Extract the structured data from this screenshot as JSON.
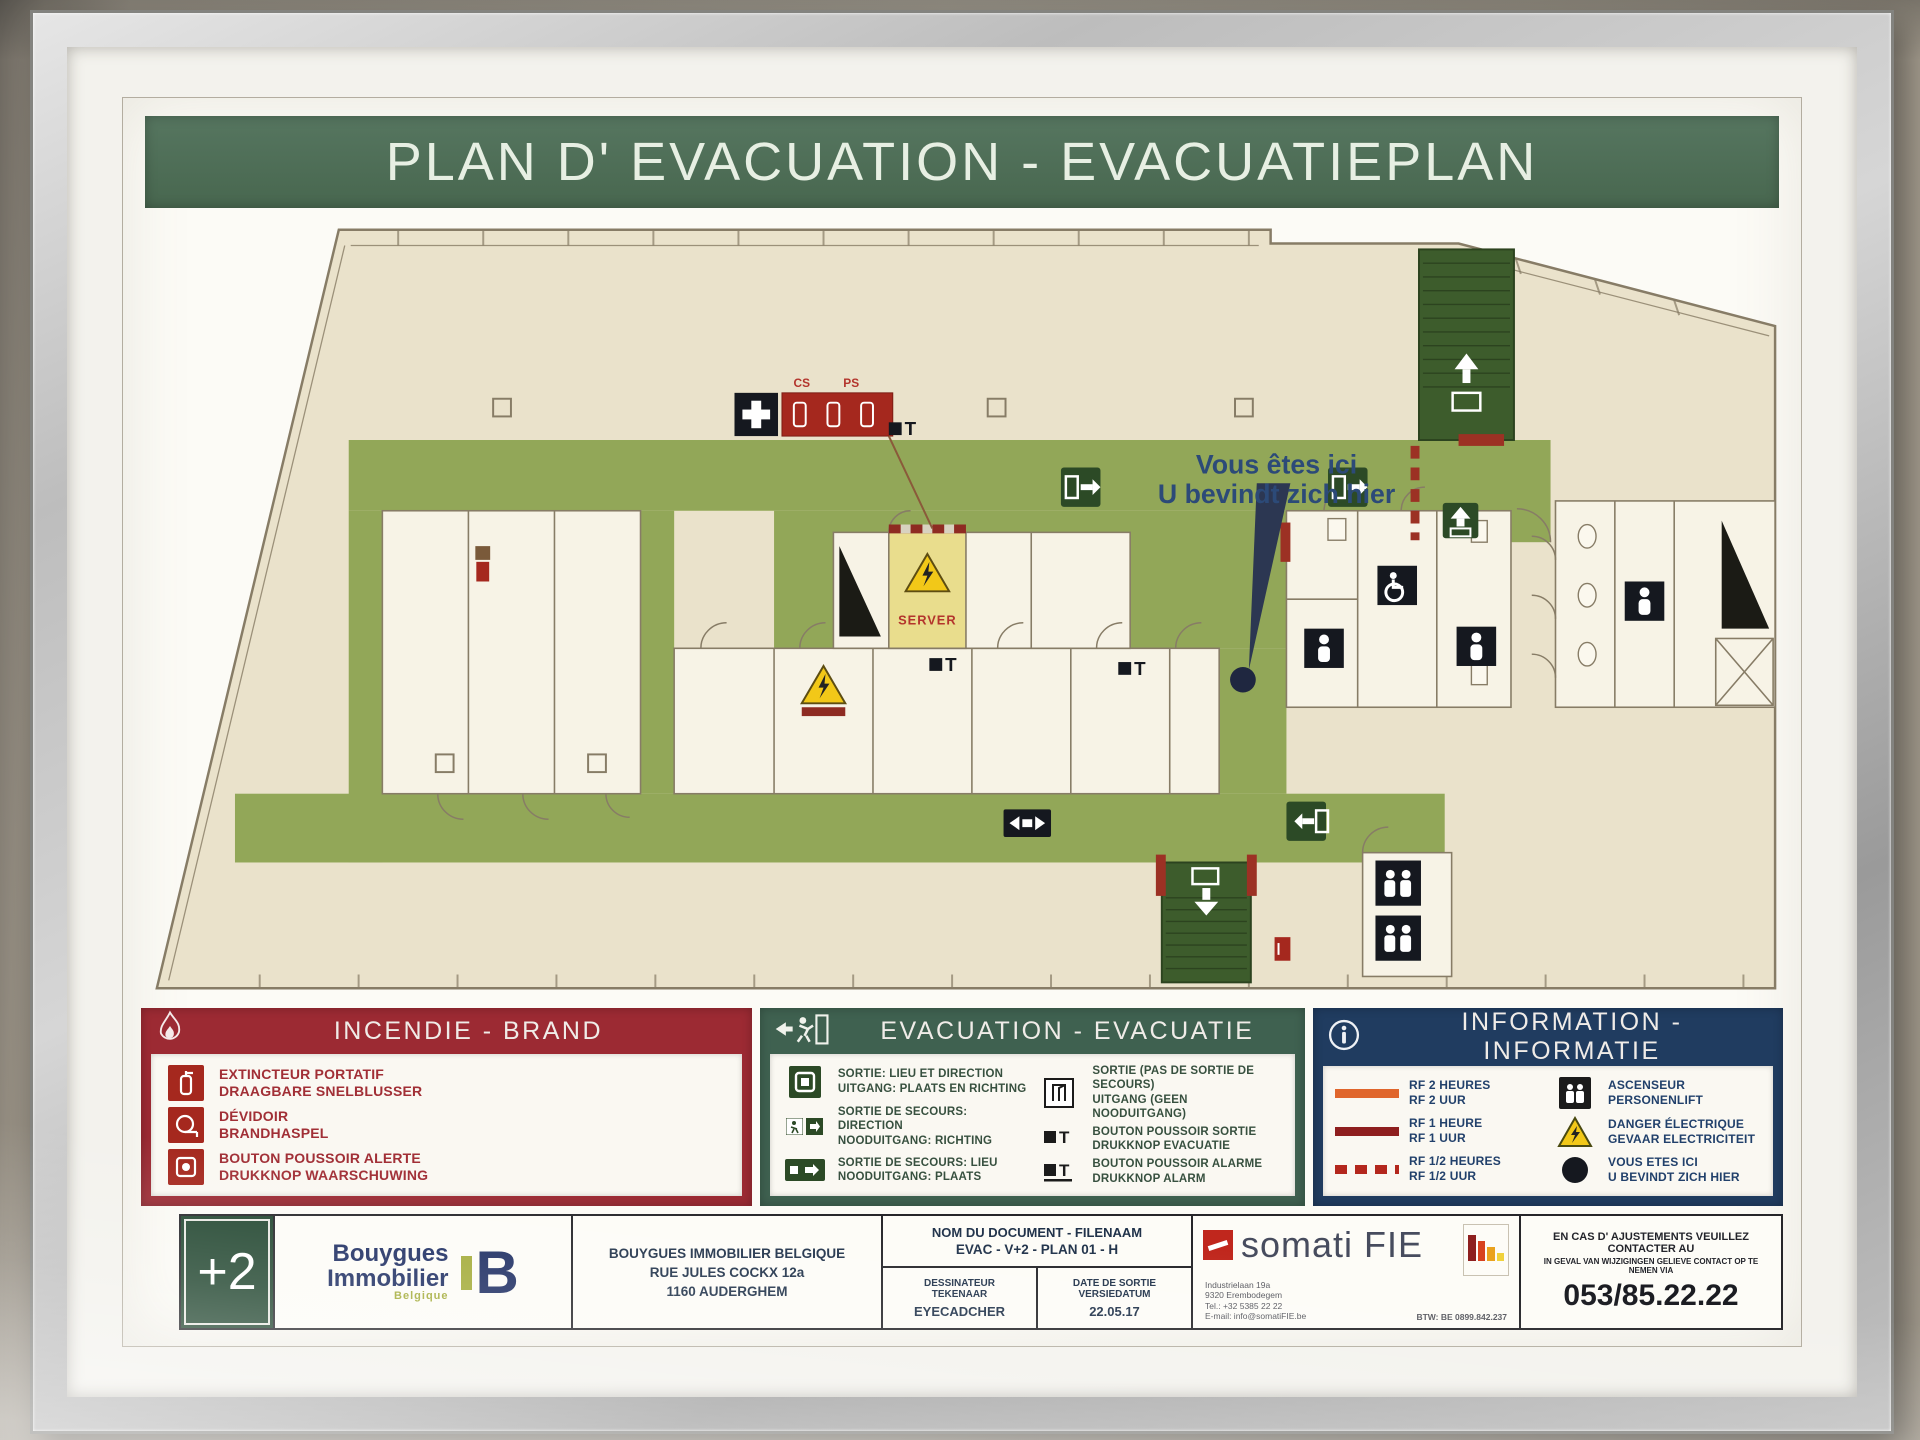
{
  "title": "PLAN D' EVACUATION - EVACUATIEPLAN",
  "colors": {
    "title_green": "#4f7058",
    "incendie_red": "#9c2a33",
    "evacuation_green": "#3f6150",
    "information_navy": "#203c60",
    "corridor_olive": "#92a758",
    "stairwell_dark_green": "#3d5c2c",
    "floor_beige": "#eae2cb"
  },
  "plan": {
    "you_are_here_line1": "Vous êtes ici",
    "you_are_here_line2": "U bevindt zich hier",
    "server_label": "SERVER",
    "cs_label": "CS",
    "ps_label": "PS"
  },
  "legend": {
    "incendie": {
      "title": "INCENDIE - BRAND",
      "items": [
        {
          "fr": "EXTINCTEUR PORTATIF",
          "nl": "DRAAGBARE SNELBLUSSER"
        },
        {
          "fr": "DÉVIDOIR",
          "nl": "BRANDHASPEL"
        },
        {
          "fr": "BOUTON POUSSOIR ALERTE",
          "nl": "DRUKKNOP WAARSCHUWING"
        }
      ]
    },
    "evacuation": {
      "title": "EVACUATION - EVACUATIE",
      "items_left": [
        {
          "fr": "SORTIE: LIEU ET DIRECTION",
          "nl": "UITGANG: PLAATS EN RICHTING"
        },
        {
          "fr": "SORTIE DE SECOURS: DIRECTION",
          "nl": "NOODUITGANG: RICHTING"
        },
        {
          "fr": "SORTIE DE SECOURS: LIEU",
          "nl": "NOODUITGANG: PLAATS"
        }
      ],
      "items_right": [
        {
          "fr": "SORTIE (PAS DE SORTIE DE SECOURS)",
          "nl": "UITGANG (GEEN NOODUITGANG)"
        },
        {
          "fr": "BOUTON POUSSOIR SORTIE",
          "nl": "DRUKKNOP EVACUATIE"
        },
        {
          "fr": "BOUTON POUSSOIR ALARME",
          "nl": "DRUKKNOP ALARM"
        }
      ]
    },
    "information": {
      "title": "INFORMATION - INFORMATIE",
      "items_left": [
        {
          "fr": "RF 2 HEURES",
          "nl": "RF 2 UUR"
        },
        {
          "fr": "RF 1 HEURE",
          "nl": "RF 1 UUR"
        },
        {
          "fr": "RF 1/2 HEURES",
          "nl": "RF 1/2 UUR"
        }
      ],
      "items_right": [
        {
          "fr": "ASCENSEUR",
          "nl": "PERSONENLIFT"
        },
        {
          "fr": "DANGER ÉLECTRIQUE",
          "nl": "GEVAAR ELECTRICITEIT"
        },
        {
          "fr": "VOUS ETES ICI",
          "nl": "U BEVINDT ZICH HIER"
        }
      ]
    }
  },
  "footer": {
    "floor_label": "+2",
    "logo": {
      "line1": "Bouygues",
      "line2": "Immobilier",
      "sub": "Belgique",
      "mark": "B"
    },
    "address": [
      "BOUYGUES IMMOBILIER BELGIQUE",
      "RUE JULES COCKX 12a",
      "1160 AUDERGHEM"
    ],
    "document": {
      "header_label": "NOM DU DOCUMENT - FILENAAM",
      "document_name": "EVAC - V+2 - PLAN 01 - H",
      "designer_label_fr": "DESSINATEUR",
      "designer_label_nl": "TEKENAAR",
      "designer_value": "EYECADCHER",
      "date_label_fr": "DATE DE SORTIE",
      "date_label_nl": "VERSIEDATUM",
      "date_value": "22.05.17"
    },
    "somati": {
      "name": "somati FIE",
      "address_lines": [
        "Industrielaan 19a",
        "9320 Erembodegem",
        "Tel.: +32 5385 22 22",
        "E-mail: info@somatiFIE.be"
      ],
      "vat": "BTW: BE 0899.842.237"
    },
    "contact": {
      "line_fr": "EN CAS D' AJUSTEMENTS VEUILLEZ CONTACTER AU",
      "line_nl": "IN GEVAL VAN WIJZIGINGEN GELIEVE CONTACT OP TE NEMEN VIA",
      "phone": "053/85.22.22"
    }
  }
}
